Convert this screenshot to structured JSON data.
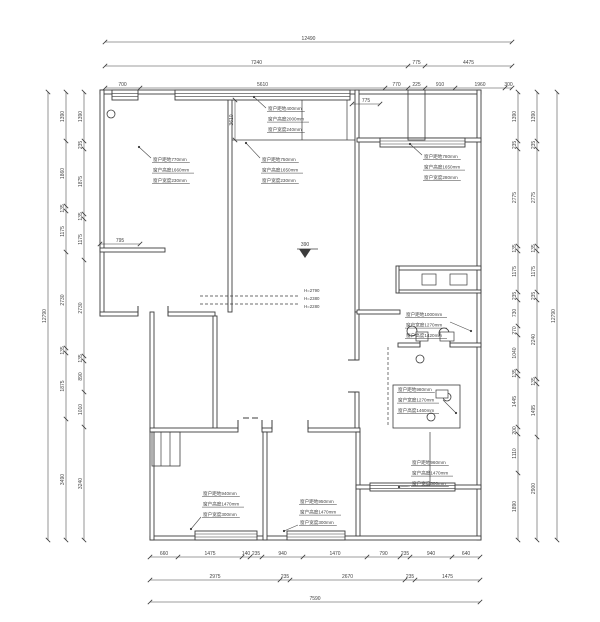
{
  "canvas": {
    "width": 600,
    "height": 622,
    "background": "#ffffff",
    "ink": "#3c3c3c",
    "dim_ink": "#4c4c4c"
  },
  "plan": {
    "walls": [
      [
        100,
        90,
        381,
        4
      ],
      [
        477,
        90,
        4,
        450
      ],
      [
        150,
        536,
        331,
        4
      ],
      [
        100,
        90,
        4,
        226
      ],
      [
        100,
        312,
        38,
        4
      ],
      [
        168,
        312,
        47,
        4
      ],
      [
        150,
        312,
        4,
        228
      ],
      [
        228,
        98,
        4,
        214
      ],
      [
        100,
        248,
        65,
        4
      ],
      [
        355,
        90,
        4,
        222
      ],
      [
        355,
        312,
        4,
        48
      ],
      [
        355,
        392,
        4,
        38
      ],
      [
        357,
        138,
        124,
        4
      ],
      [
        213,
        316,
        4,
        114
      ],
      [
        150,
        428,
        88,
        4
      ],
      [
        262,
        428,
        10,
        4
      ],
      [
        308,
        428,
        52,
        4
      ],
      [
        263,
        432,
        4,
        108
      ],
      [
        356,
        432,
        4,
        104
      ],
      [
        398,
        266,
        83,
        4
      ],
      [
        398,
        290,
        83,
        3
      ],
      [
        396,
        266,
        3,
        27
      ],
      [
        398,
        343,
        22,
        4
      ],
      [
        450,
        343,
        31,
        4
      ],
      [
        357,
        310,
        43,
        4
      ],
      [
        356,
        485,
        14,
        4
      ],
      [
        455,
        485,
        26,
        4
      ]
    ],
    "window_bands": [
      [
        175,
        90,
        175,
        10
      ],
      [
        112,
        90,
        26,
        10
      ],
      [
        380,
        138,
        85,
        9
      ],
      [
        195,
        531,
        62,
        9
      ],
      [
        287,
        531,
        58,
        9
      ],
      [
        370,
        483,
        85,
        8
      ]
    ],
    "thin_lines": [
      [
        232,
        140,
        355,
        140
      ],
      [
        302,
        100,
        302,
        140
      ],
      [
        347,
        100,
        347,
        140
      ],
      [
        430,
        432,
        430,
        485
      ],
      [
        161,
        432,
        161,
        466
      ],
      [
        170,
        432,
        170,
        466
      ]
    ],
    "thin_rects": [
      [
        393,
        385,
        67,
        43
      ],
      [
        152,
        432,
        28,
        34
      ],
      [
        408,
        90,
        17,
        50
      ]
    ],
    "dashed_lines": [
      [
        200,
        296,
        300,
        296
      ],
      [
        200,
        304,
        300,
        304
      ],
      [
        388,
        347,
        388,
        426
      ]
    ],
    "jamb_ticks": [
      [
        138,
        306,
        138,
        316
      ],
      [
        168,
        306,
        168,
        316
      ],
      [
        238,
        420,
        238,
        430
      ],
      [
        262,
        420,
        262,
        430
      ],
      [
        272,
        420,
        272,
        430
      ],
      [
        308,
        420,
        308,
        430
      ],
      [
        348,
        360,
        358,
        360
      ],
      [
        348,
        392,
        358,
        392
      ],
      [
        420,
        339,
        420,
        347
      ],
      [
        450,
        339,
        450,
        347
      ],
      [
        243,
        418,
        249,
        418
      ],
      [
        252,
        418,
        258,
        418
      ]
    ],
    "circles": [
      [
        111,
        114,
        4
      ],
      [
        412,
        331,
        5
      ],
      [
        444,
        333,
        5
      ],
      [
        420,
        359,
        4
      ],
      [
        447,
        397,
        4
      ],
      [
        431,
        417,
        4
      ]
    ],
    "fixture_rects": [
      [
        422,
        274,
        14,
        11
      ],
      [
        450,
        274,
        17,
        11
      ],
      [
        416,
        332,
        12,
        9
      ],
      [
        440,
        332,
        14,
        9
      ],
      [
        436,
        390,
        12,
        8
      ]
    ]
  },
  "dim_chains": [
    {
      "o": "h",
      "at": 42,
      "ticks": [
        105,
        512
      ],
      "labels": [
        "12490"
      ]
    },
    {
      "o": "h",
      "at": 66,
      "ticks": [
        105,
        408,
        425,
        512
      ],
      "labels": [
        "7240",
        "775",
        "4475"
      ]
    },
    {
      "o": "h",
      "at": 88,
      "ticks": [
        105,
        140,
        385,
        408,
        425,
        455,
        505,
        512
      ],
      "labels": [
        "700",
        "5610",
        "770",
        "225",
        "910",
        "1960",
        "300"
      ]
    },
    {
      "o": "h",
      "at": 557,
      "ticks": [
        150,
        178,
        242,
        250,
        262,
        303,
        367,
        400,
        410,
        452,
        480
      ],
      "labels": [
        "660",
        "1475",
        "140",
        "235",
        "940",
        "1470",
        "790",
        "235",
        "940",
        "640"
      ]
    },
    {
      "o": "h",
      "at": 580,
      "ticks": [
        150,
        280,
        290,
        405,
        415,
        480
      ],
      "labels": [
        "2975",
        "235",
        "2670",
        "235",
        "1475"
      ]
    },
    {
      "o": "h",
      "at": 602,
      "ticks": [
        150,
        480
      ],
      "labels": [
        "7590"
      ]
    },
    {
      "o": "v",
      "at": 48,
      "ticks": [
        92,
        540
      ],
      "labels": [
        "12790"
      ]
    },
    {
      "o": "v",
      "at": 66,
      "ticks": [
        92,
        141,
        206,
        211,
        252,
        348,
        353,
        419,
        540
      ],
      "labels": [
        "1390",
        "1860",
        "135",
        "1175",
        "2730",
        "135",
        "1875",
        "3490"
      ]
    },
    {
      "o": "v",
      "at": 84,
      "ticks": [
        92,
        141,
        149,
        214,
        219,
        260,
        356,
        361,
        392,
        427,
        540
      ],
      "labels": [
        "1390",
        "235",
        "1875",
        "135",
        "1175",
        "2730",
        "135",
        "890",
        "1010",
        "3240"
      ]
    },
    {
      "o": "v",
      "at": 518,
      "ticks": [
        92,
        141,
        149,
        246,
        251,
        292,
        300,
        326,
        335,
        371,
        376,
        427,
        434,
        473,
        540
      ],
      "labels": [
        "1390",
        "235",
        "2775",
        "135",
        "1175",
        "235",
        "730",
        "270",
        "1040",
        "135",
        "1445",
        "200",
        "1110",
        "1890"
      ]
    },
    {
      "o": "v",
      "at": 537,
      "ticks": [
        92,
        141,
        149,
        246,
        251,
        292,
        300,
        379,
        384,
        437,
        540
      ],
      "labels": [
        "1390",
        "235",
        "2775",
        "135",
        "1175",
        "235",
        "2240",
        "135",
        "1495",
        "2900"
      ]
    },
    {
      "o": "v",
      "at": 557,
      "ticks": [
        92,
        540
      ],
      "labels": [
        "12790"
      ]
    },
    {
      "o": "h",
      "at": 244,
      "ticks": [
        100,
        140
      ],
      "labels": [
        "795"
      ]
    },
    {
      "o": "v",
      "at": 235,
      "ticks": [
        100,
        140
      ],
      "labels": [
        "3610"
      ]
    },
    {
      "o": "h",
      "at": 104,
      "ticks": [
        352,
        380
      ],
      "labels": [
        "775"
      ]
    }
  ],
  "window_annotations": [
    {
      "x": 268,
      "y": 110,
      "lines": [
        "窗户距地400mm",
        "窗户高度2000mm",
        "窗户宽度240mm"
      ],
      "leader": [
        [
          266,
          108
        ],
        [
          254,
          97
        ]
      ]
    },
    {
      "x": 153,
      "y": 161,
      "lines": [
        "窗户距地770mm",
        "窗户高度1660mm",
        "窗户宽度230mm"
      ],
      "leader": [
        [
          151,
          158
        ],
        [
          139,
          147
        ]
      ]
    },
    {
      "x": 262,
      "y": 161,
      "lines": [
        "窗户距地750mm",
        "窗户高度1650mm",
        "窗户宽度230mm"
      ],
      "leader": [
        [
          260,
          158
        ],
        [
          246,
          143
        ]
      ]
    },
    {
      "x": 424,
      "y": 158,
      "lines": [
        "窗户距地780mm",
        "窗户高度1650mm",
        "窗户宽度280mm"
      ],
      "leader": [
        [
          422,
          155
        ],
        [
          410,
          144
        ]
      ]
    },
    {
      "x": 203,
      "y": 495,
      "lines": [
        "窗户距地940mm",
        "窗户高度1470mm",
        "窗户宽度300mm"
      ],
      "leader": [
        [
          201,
          517
        ],
        [
          191,
          529
        ]
      ]
    },
    {
      "x": 300,
      "y": 503,
      "lines": [
        "窗户距地950mm",
        "窗户高度1470mm",
        "窗户宽度300mm"
      ],
      "leader": [
        [
          298,
          525
        ],
        [
          284,
          531
        ]
      ]
    },
    {
      "x": 412,
      "y": 464,
      "lines": [
        "窗户距地960mm",
        "窗户高度1470mm",
        "窗户宽度300mm"
      ],
      "leader": [
        [
          410,
          486
        ],
        [
          399,
          487
        ]
      ]
    },
    {
      "x": 406,
      "y": 316,
      "lines": [
        "窗户距地1000mm",
        "窗户宽度1270mm",
        "窗户高度1420mm"
      ],
      "leader": [
        [
          450,
          322
        ],
        [
          471,
          331
        ]
      ]
    },
    {
      "x": 398,
      "y": 391,
      "lines": [
        "窗户距地980mm",
        "窗户宽度1270mm",
        "窗户高度1460mm"
      ],
      "leader": [
        [
          443,
          400
        ],
        [
          456,
          413
        ]
      ]
    }
  ],
  "level_labels": [
    {
      "t": "H=2790",
      "x": 304,
      "y": 292
    },
    {
      "t": "H=2380",
      "x": 304,
      "y": 300
    },
    {
      "t": "H=2280",
      "x": 304,
      "y": 308
    }
  ],
  "elevation_marker": {
    "label": "390",
    "tip_x": 305,
    "tip_y": 258,
    "base_y": 249,
    "half_w": 6,
    "bar_x1": 297,
    "bar_x2": 318,
    "text_x": 305,
    "text_y": 246
  }
}
